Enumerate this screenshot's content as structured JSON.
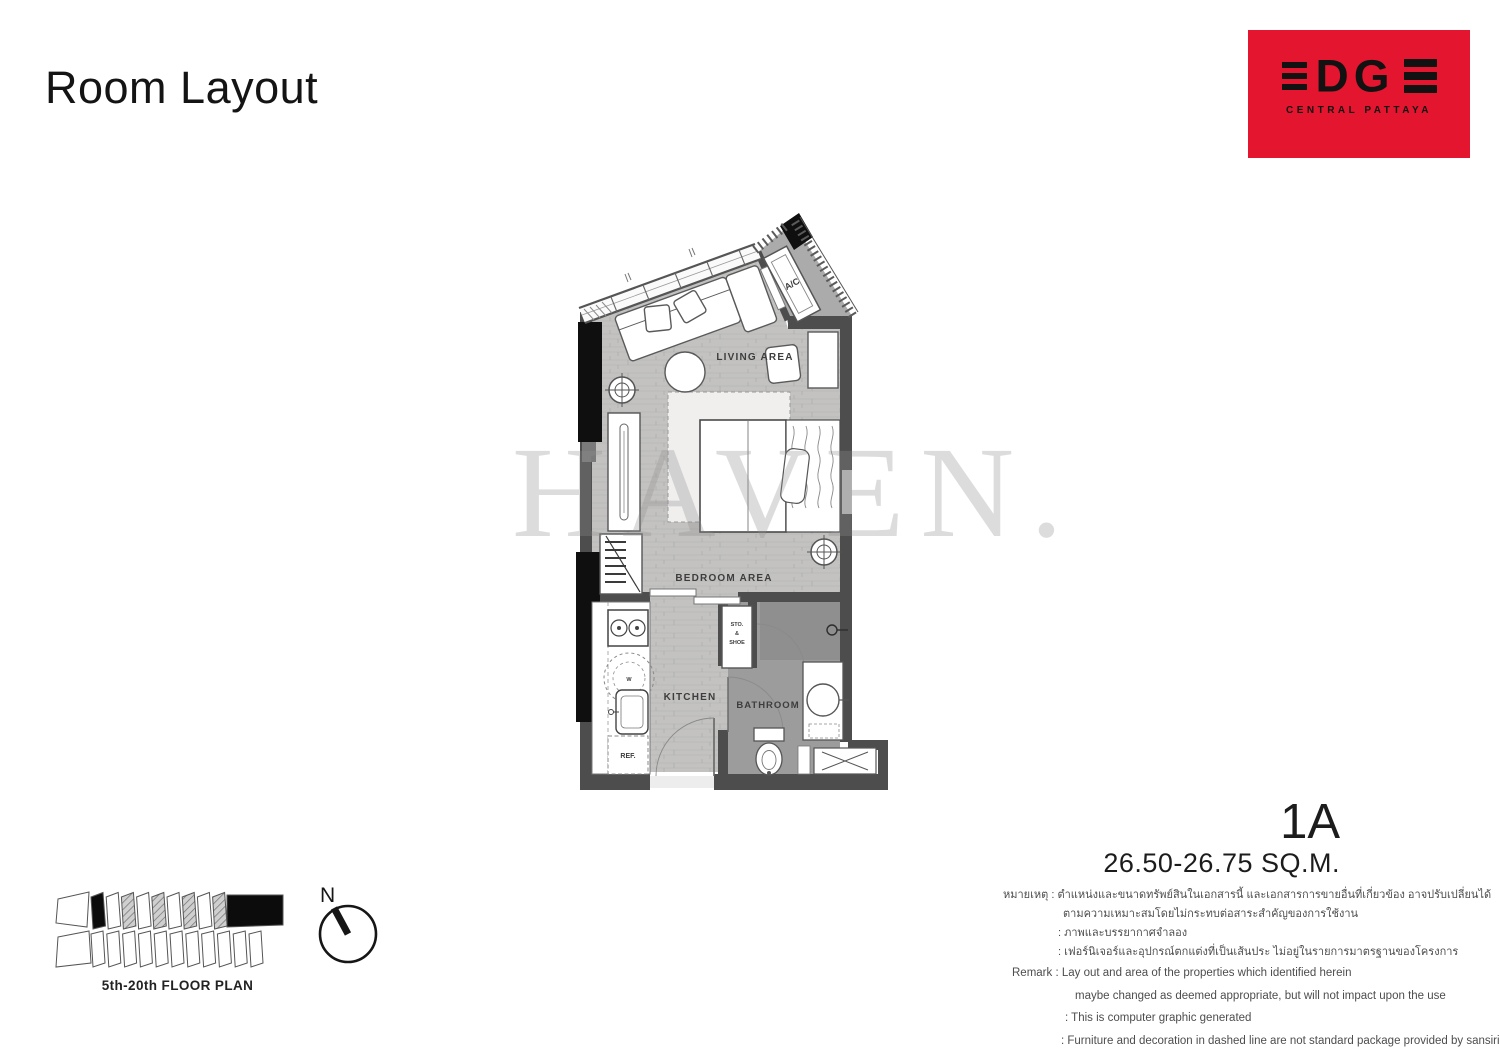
{
  "page": {
    "title": "Room Layout"
  },
  "logo": {
    "brand": "EDGE",
    "brand_mid": "DG",
    "subtitle": "CENTRAL PATTAYA",
    "bg_color": "#E3152F"
  },
  "plan": {
    "rooms": {
      "living": "LIVING AREA",
      "bedroom": "BEDROOM AREA",
      "kitchen": "KITCHEN",
      "bathroom": "BATHROOM"
    },
    "fixtures": {
      "ac": "A/C",
      "sto1": "STO.",
      "sto2": "&",
      "sto3": "SHOE",
      "ref": "REF.",
      "washer": "W"
    }
  },
  "watermark": {
    "text": "HAVEN."
  },
  "unit": {
    "name": "1A",
    "area": "26.50-26.75 SQ.M."
  },
  "key_plan": {
    "caption": "5th-20th FLOOR PLAN",
    "compass_label": "N"
  },
  "remarks_thai": {
    "label": "หมายเหตุ :",
    "lines": [
      "ตำแหน่งและขนาดทรัพย์สินในเอกสารนี้ และเอกสารการขายอื่นที่เกี่ยวข้อง อาจปรับเปลี่ยนได้",
      "ตามความเหมาะสมโดยไม่กระทบต่อสาระสำคัญของการใช้งาน",
      ": ภาพและบรรยากาศจำลอง",
      ": เฟอร์นิเจอร์และอุปกรณ์ตกแต่งที่เป็นเส้นประ ไม่อยู่ในรายการมาตรฐานของโครงการ"
    ]
  },
  "remarks_en": {
    "label": "Remark :",
    "lines": [
      "Lay out and area of the properties which identified herein",
      "maybe changed as deemed appropriate, but will not impact upon the use",
      ": This is computer graphic generated",
      ": Furniture and decoration in dashed line are not standard package provided by sansiri"
    ]
  }
}
